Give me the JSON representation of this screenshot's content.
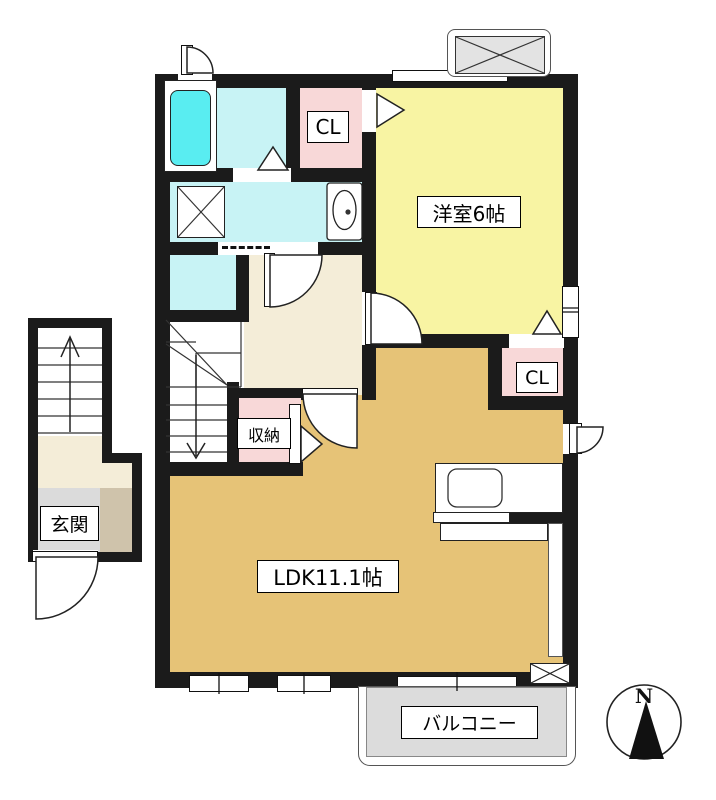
{
  "rooms": {
    "yoshitsu": {
      "label": "洋室6帖"
    },
    "ldk": {
      "label": "LDK11.1帖"
    },
    "cl_top": {
      "label": "CL"
    },
    "cl_right": {
      "label": "CL"
    },
    "shuno": {
      "label": "収納"
    },
    "genkan": {
      "label": "玄関"
    },
    "balcony": {
      "label": "バルコニー"
    }
  },
  "compass": {
    "north": "N"
  },
  "colors": {
    "wall": "#1B1B1B",
    "yoshitsu_yellow": "#F8F4A3",
    "ldk_tan": "#E6C377",
    "closet_pink": "#F8D8D8",
    "wet_cyan": "#C8F3F5",
    "bathtub_cyan": "#59EDF1",
    "hall_cream": "#F4EDD8",
    "genkan_gray": "#DBDBDB",
    "genkan_step_tan": "#CFC3AB",
    "balcony_gray": "#DCDCDC",
    "ac_unit_gray": "#E3E3E3"
  }
}
